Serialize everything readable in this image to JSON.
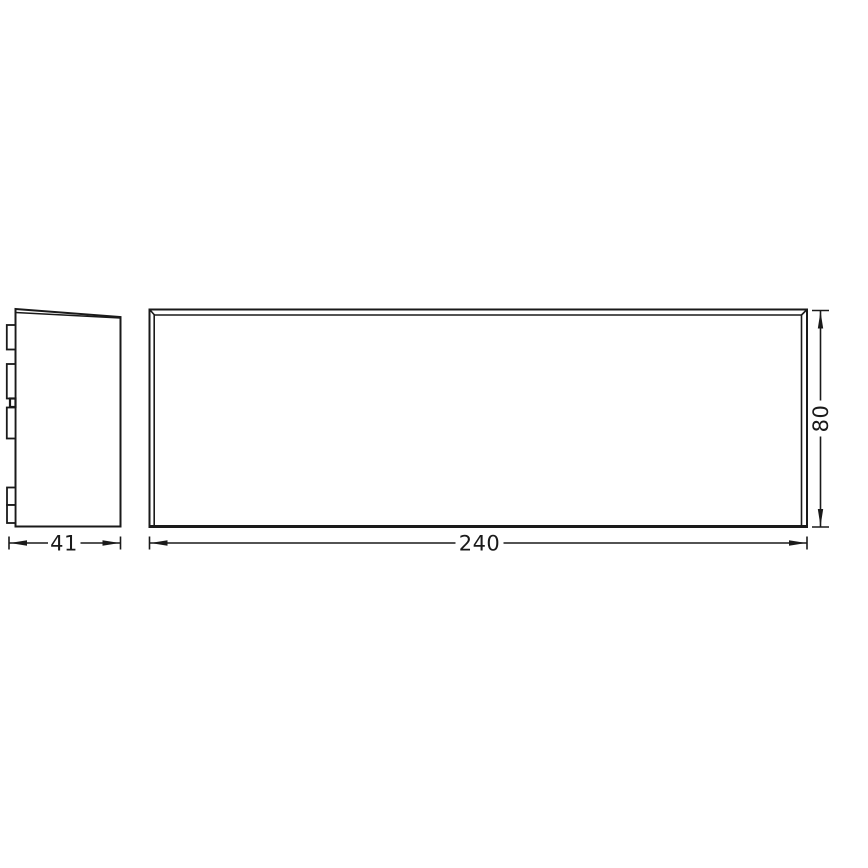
{
  "page": {
    "background": "#ffffff",
    "line_color": "#1a1a1a"
  },
  "drawing": {
    "kind": "technical-dimension-drawing",
    "views": {
      "side_view": {
        "id": "side-view"
      },
      "front_view": {
        "id": "front-view"
      }
    },
    "dims": {
      "depth": {
        "label": "41",
        "orientation": "horizontal"
      },
      "width": {
        "label": "240",
        "orientation": "horizontal"
      },
      "height": {
        "label": "80",
        "orientation": "vertical"
      }
    }
  }
}
